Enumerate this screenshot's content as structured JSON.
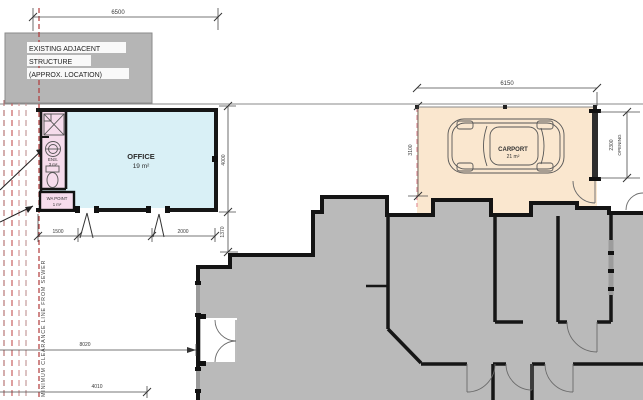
{
  "plan": {
    "existing_structure": {
      "line1": "EXISTING ADJACENT",
      "line2": "STRUCTURE",
      "line3": "(APPROX. LOCATION)"
    },
    "office": {
      "name": "OFFICE",
      "area": "19 m²"
    },
    "ensuite": {
      "name": "ENS.",
      "area": "3 m²"
    },
    "wa_point": {
      "name": "WA POINT",
      "area": "1 m²"
    },
    "carport": {
      "name": "CARPORT",
      "area": "21 m²"
    },
    "clearance_note": "MINIMUM CLEARANCE LINE FROM SEWER",
    "dimensions": {
      "site_width": "6500",
      "office_depth": "4000",
      "office_opening_left": "1500",
      "office_opening_right": "2000",
      "office_to_house": "1370",
      "carport_width": "6150",
      "carport_depth": "3100",
      "opening_size": "2300",
      "opening_word": "OPENING",
      "sewer_to_house": "8020",
      "sewer_offset": "4010"
    },
    "colors": {
      "office_fill": "#d9f0f6",
      "ensuite_fill": "#f6dcec",
      "carport_fill": "#fae7cf",
      "house_fill": "#bababa",
      "structure_fill": "#b5b5b5",
      "clearance_line": "#b03a3a"
    }
  }
}
